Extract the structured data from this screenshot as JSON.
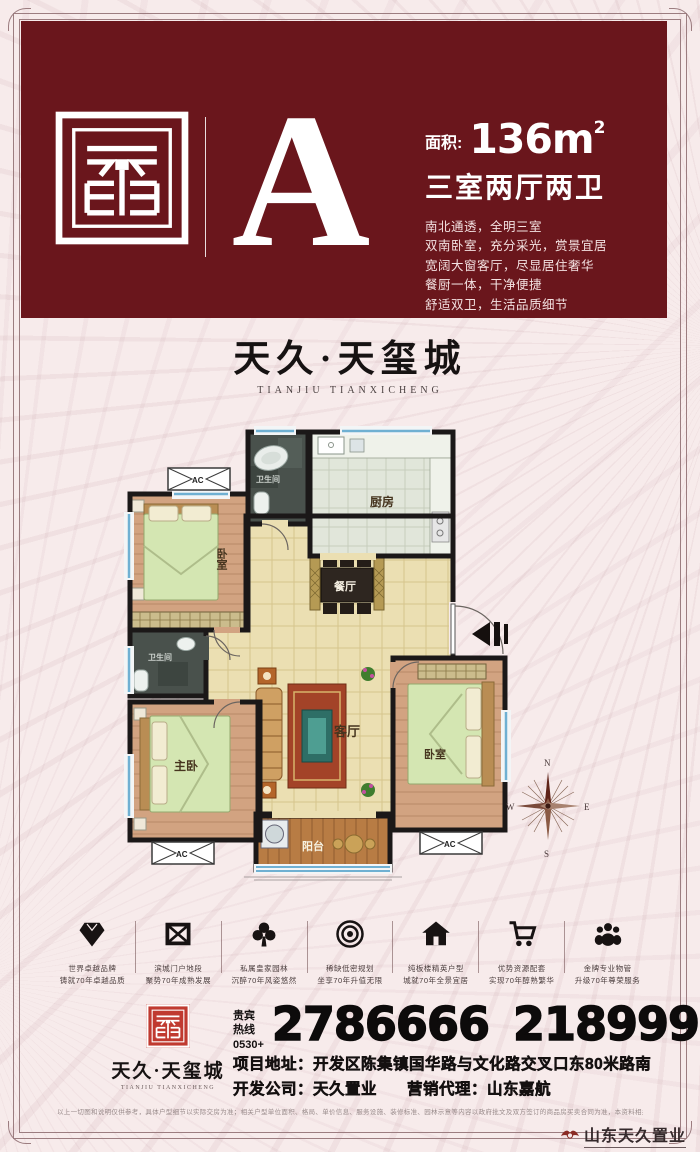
{
  "colors": {
    "maroon": "#6a161c",
    "seal_red": "#c03a30",
    "bg": "#f7ebeb",
    "wall": "#1b1818",
    "window_blue": "#6fb0d2"
  },
  "header": {
    "unit_letter": "A",
    "area_label": "面积:",
    "area_value": "136m",
    "area_sup": "2",
    "type_title": "三室两厅两卫",
    "desc_lines": [
      "南北通透，全明三室",
      "双南卧室，充分采光，赏景宜居",
      "宽阔大窗客厅，尽显居住奢华",
      "餐厨一体，干净便捷",
      "舒适双卫，生活品质细节"
    ]
  },
  "brand": {
    "name": "天久·天玺城",
    "name_en": "TIANJIU TIANXICHENG"
  },
  "floorplan": {
    "rooms": {
      "bedroom_nw": "卧室",
      "bath_top": "卫生间",
      "kitchen": "厨房",
      "dining": "餐厅",
      "bath_mid": "卫生间",
      "living": "客厅",
      "master": "主卧",
      "bedroom_se": "卧室",
      "balcony": "阳台"
    },
    "ac_label": "AC",
    "compass": {
      "n": "N",
      "e": "E",
      "s": "S",
      "w": "W"
    }
  },
  "features": [
    {
      "icon": "diamond-icon",
      "line1": "世界卓越品牌",
      "line2": "铸就70年卓越品质"
    },
    {
      "icon": "envelope-icon",
      "line1": "滨城门户地段",
      "line2": "聚势70年成熟发展"
    },
    {
      "icon": "clover-icon",
      "line1": "私属皇家园林",
      "line2": "沉醉70年风姿悠然"
    },
    {
      "icon": "rings-icon",
      "line1": "稀缺低密规划",
      "line2": "坐享70年升值无限"
    },
    {
      "icon": "house-icon",
      "line1": "纯板楼精英户型",
      "line2": "城就70年全景宜居"
    },
    {
      "icon": "cart-icon",
      "line1": "优势资源配套",
      "line2": "实现70年醇熟繁华"
    },
    {
      "icon": "team-icon",
      "line1": "金牌专业物管",
      "line2": "升级70年尊荣服务"
    }
  ],
  "contact": {
    "hotline_label": "贵宾热线",
    "hotline_prefix": "0530+",
    "phone1": "2786666",
    "phone2": "2189999",
    "address_label": "项目地址：",
    "address": "开发区陈集镇国华路与文化路交叉口东80米路南",
    "developer_label": "开发公司：",
    "developer": "天久置业",
    "agent_label": "营销代理：",
    "agent": "山东嘉航"
  },
  "footer": {
    "disclaimer": "以上一切图和说明仅供参考，具体户型细节以实际交房为准；相关户型单位面积、格局、单价信息、服务设施、装修标准、园林示意等内容以政府批文及双方签订的商品房买卖合同为准，本资料相关内容不排除因政府规划、规定及开发商未能控制的原因发生变化，本公司保留修改权利，敬请留意最新资料。",
    "corner_brand": "山东天久置业"
  }
}
